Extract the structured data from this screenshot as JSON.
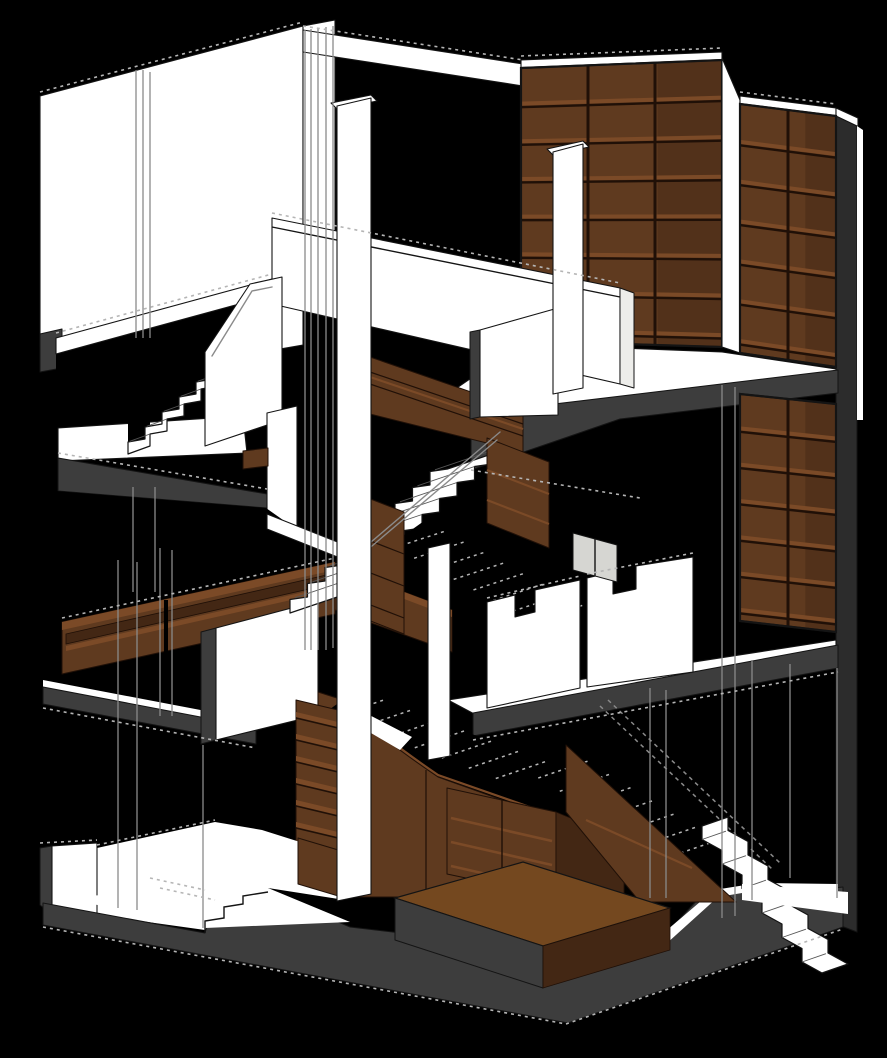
{
  "colors": {
    "background": "#000000",
    "wall": "#ffffff",
    "wall_shade": "#ededea",
    "glazing": "#d6d6d2",
    "outline": "#141414",
    "poche": "#3d3d3d",
    "poche_dark": "#2c2c2c",
    "wood": "#5f3a1f",
    "wood_dark": "#432714",
    "wood_light": "#7b4a27",
    "wood_top": "#74481f",
    "wood_line": "#201007",
    "line_gray": "#8a8a8a",
    "hatch": "#b5b5b5"
  },
  "scene": {
    "style": "hidden-line architectural cutaway axonometric on black background",
    "subject": "three-storey interior section with central switchback stair, full-height wood bookshelf walls, wood benches and a wood plinth box",
    "bookshelves": {
      "upper_left": {
        "rows": 7,
        "cols": 3
      },
      "upper_right": {
        "rows": 6,
        "cols": 2
      },
      "mid_right": {
        "rows": 6,
        "cols": 2
      }
    },
    "stairs": {
      "center_flight_treads": 9,
      "upper_left_flight_treads": 5,
      "lower_right_flight_treads": 6,
      "shadow_flight_treads": 8
    },
    "ladder_shelf_rungs": 7,
    "cabinet_shelves": 3
  }
}
